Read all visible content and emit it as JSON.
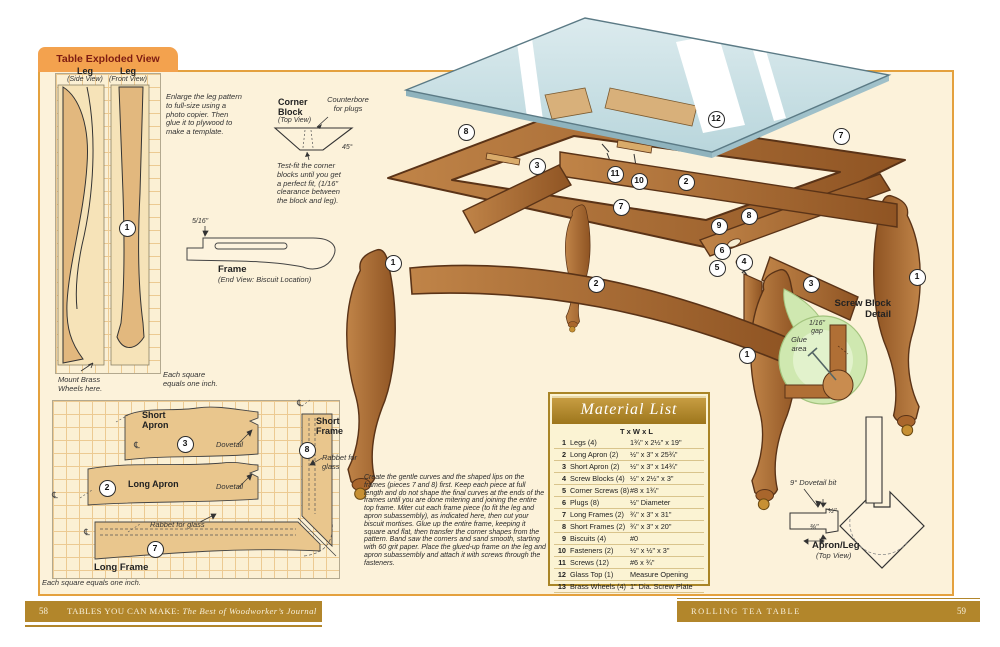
{
  "page": {
    "tab": "Table Exploded View"
  },
  "footer": {
    "left_page": "58",
    "left_title": "TABLES YOU CAN MAKE:",
    "left_subtitle": " The Best of Woodworker’s Journal",
    "right_title": "ROLLING TEA TABLE",
    "right_page": "59"
  },
  "leg_patterns": {
    "side_label": "Leg",
    "side_sub": "(Side View)",
    "front_label": "Leg",
    "front_sub": "(Front View)",
    "enlarge_note": "Enlarge the leg pattern\nto full-size using a\nphoto copier. Then\nglue it to plywood to\nmake a template.",
    "mount_note": "Mount Brass\nWheels here.",
    "square_note": "Each square\nequals one inch."
  },
  "corner_block": {
    "title": "Corner\nBlock",
    "sub": "(Top View)",
    "counterbore": "Counterbore\nfor plugs",
    "angle": "45°",
    "note": "Test-fit the corner\nblocks until you get\na perfect fit, (1/16\"\nclearance between\nthe block and leg)."
  },
  "frame_end": {
    "title": "Frame",
    "sub": "(End View: Biscuit Location)",
    "dim": "5/16\""
  },
  "patterns": {
    "short_apron": "Short\nApron",
    "long_apron": "Long Apron",
    "long_frame": "Long Frame",
    "short_frame": "Short\nFrame",
    "dovetail_1": "Dovetail",
    "dovetail_2": "Dovetail",
    "rabbet_left": "Rabbet for glass",
    "rabbet_right": "Rabbet for glass",
    "scale_note": "Each square equals one inch.",
    "centerline": "℄"
  },
  "instructions": "Create the gentle curves and the shaped lips on the frames (pieces 7 and 8) first. Keep each piece at full length and do not shape the final curves at the ends of the frames until you are done mitering and joining the entire top frame. Miter cut each frame piece (to fit the leg and apron subassembly), as indicated here, then cut your biscuit mortises. Glue up the entire frame, keeping it square and flat, then transfer the corner shapes from the pattern. Band saw the corners and sand smooth, starting with 60 grit paper. Place the glued-up frame on the leg and apron subassembly and attach it with screws through the fasteners.",
  "screw_block": {
    "title": "Screw Block\nDetail",
    "gap": "1/16\"\ngap",
    "glue": "Glue\narea"
  },
  "apron_leg": {
    "title": "Apron/Leg",
    "sub": "(Top View)",
    "bit_label": "9° Dovetail bit",
    "dim_thickness": "½\"",
    "dim_depth": "⅜\""
  },
  "material_list": {
    "title": "Material List",
    "col_header": "T x W x L",
    "rows": [
      {
        "num": "1",
        "name": "Legs (4)",
        "dims": "1¾\" x 2½\" x 19\""
      },
      {
        "num": "2",
        "name": "Long Apron (2)",
        "dims": "½\" x 3\" x 25¾\""
      },
      {
        "num": "3",
        "name": "Short Apron (2)",
        "dims": "½\" x 3\" x 14¾\""
      },
      {
        "num": "4",
        "name": "Screw Blocks (4)",
        "dims": "½\" x 2½\" x 3\""
      },
      {
        "num": "5",
        "name": "Corner Screws (8)",
        "dims": "#8 x 1¾\""
      },
      {
        "num": "6",
        "name": "Plugs (8)",
        "dims": "½\" Diameter"
      },
      {
        "num": "7",
        "name": "Long Frames (2)",
        "dims": "¾\" x 3\" x 31\""
      },
      {
        "num": "8",
        "name": "Short Frames (2)",
        "dims": "¾\" x 3\" x 20\""
      },
      {
        "num": "9",
        "name": "Biscuits (4)",
        "dims": "#0"
      },
      {
        "num": "10",
        "name": "Fasteners (2)",
        "dims": "½\" x ½\" x 3\""
      },
      {
        "num": "11",
        "name": "Screws (12)",
        "dims": "#6 x ¾\""
      },
      {
        "num": "12",
        "name": "Glass Top (1)",
        "dims": "Measure Opening"
      },
      {
        "num": "13",
        "name": "Brass Wheels (4)",
        "dims": "1\" Dia. Screw Plate"
      }
    ]
  },
  "callouts": [
    {
      "n": "8",
      "x": 466,
      "y": 132
    },
    {
      "n": "12",
      "x": 716,
      "y": 119
    },
    {
      "n": "3",
      "x": 537,
      "y": 166
    },
    {
      "n": "11",
      "x": 615,
      "y": 174
    },
    {
      "n": "10",
      "x": 639,
      "y": 181
    },
    {
      "n": "2",
      "x": 686,
      "y": 182
    },
    {
      "n": "7",
      "x": 621,
      "y": 207
    },
    {
      "n": "7",
      "x": 841,
      "y": 136
    },
    {
      "n": "8",
      "x": 749,
      "y": 216
    },
    {
      "n": "9",
      "x": 719,
      "y": 226
    },
    {
      "n": "6",
      "x": 722,
      "y": 251
    },
    {
      "n": "4",
      "x": 744,
      "y": 262
    },
    {
      "n": "5",
      "x": 717,
      "y": 268
    },
    {
      "n": "3",
      "x": 811,
      "y": 284
    },
    {
      "n": "1",
      "x": 917,
      "y": 277
    },
    {
      "n": "1",
      "x": 393,
      "y": 263
    },
    {
      "n": "2",
      "x": 596,
      "y": 284
    },
    {
      "n": "1",
      "x": 747,
      "y": 355
    },
    {
      "n": "1",
      "x": 127,
      "y": 228
    },
    {
      "n": "3",
      "x": 185,
      "y": 444
    },
    {
      "n": "2",
      "x": 107,
      "y": 488
    },
    {
      "n": "7",
      "x": 155,
      "y": 549
    },
    {
      "n": "8",
      "x": 307,
      "y": 450
    }
  ]
}
